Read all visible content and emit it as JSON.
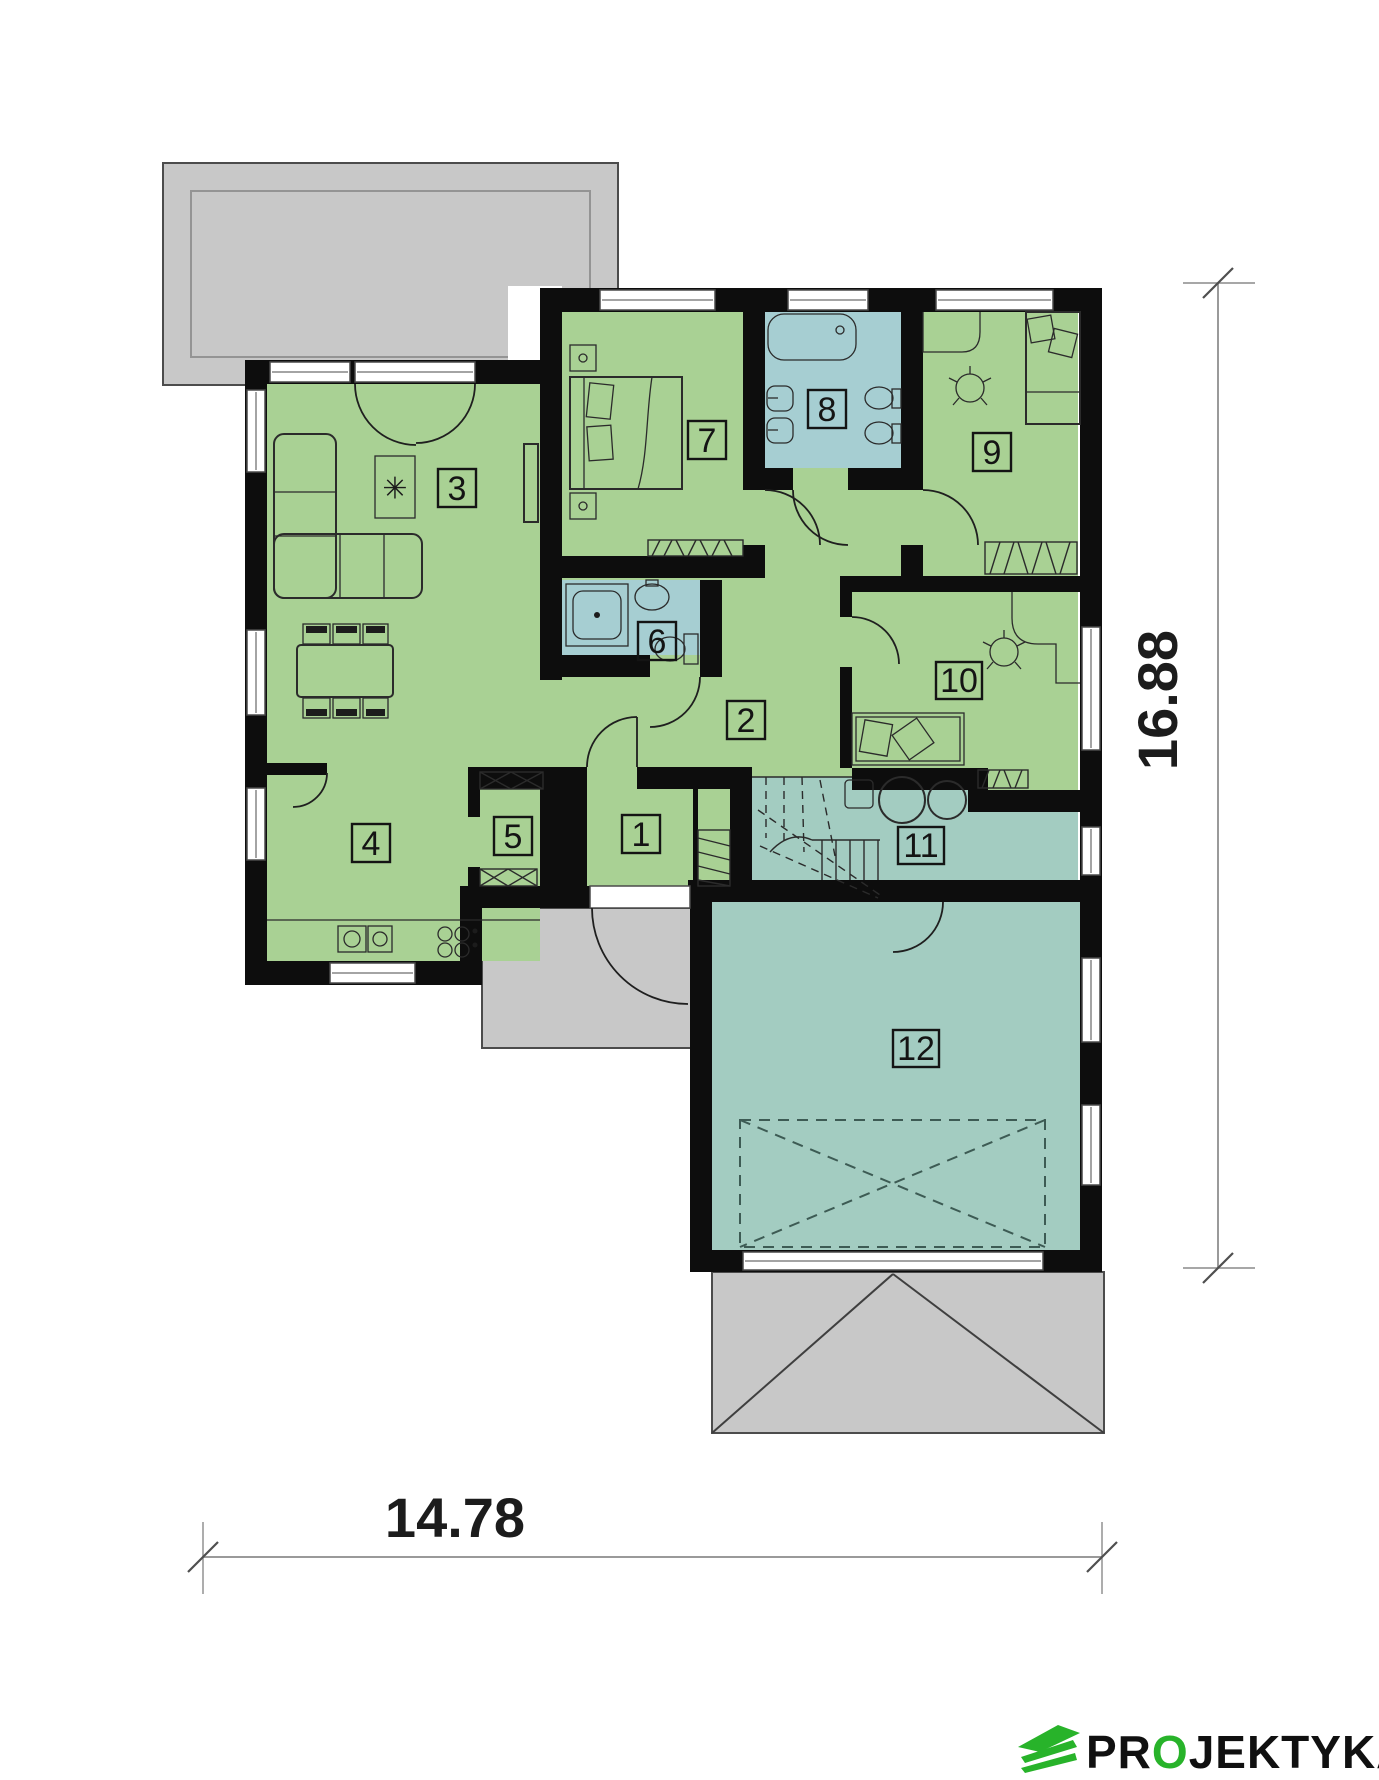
{
  "plan": {
    "type": "floor-plan",
    "rooms": [
      {
        "number": "1"
      },
      {
        "number": "2"
      },
      {
        "number": "3"
      },
      {
        "number": "4"
      },
      {
        "number": "5"
      },
      {
        "number": "6"
      },
      {
        "number": "7"
      },
      {
        "number": "8"
      },
      {
        "number": "9"
      },
      {
        "number": "10"
      },
      {
        "number": "11"
      },
      {
        "number": "12"
      }
    ],
    "dimensions": {
      "width": "14.78",
      "height": "16.88"
    }
  },
  "icons": {
    "plant": "✳"
  },
  "logo": {
    "prefix": "PR",
    "accent": "O",
    "suffix": "JEKTYKA",
    "full": "PROJEKTYKA"
  },
  "colors": {
    "room_green": "#a9d194",
    "bath_blue": "#a6ced2",
    "tech_teal": "#a3ccc1",
    "wall_black": "#0d0d0d",
    "terrace_gray": "#c8c8c8",
    "logo_green": "#28b32a",
    "dim_text": "#1c1c1c"
  }
}
